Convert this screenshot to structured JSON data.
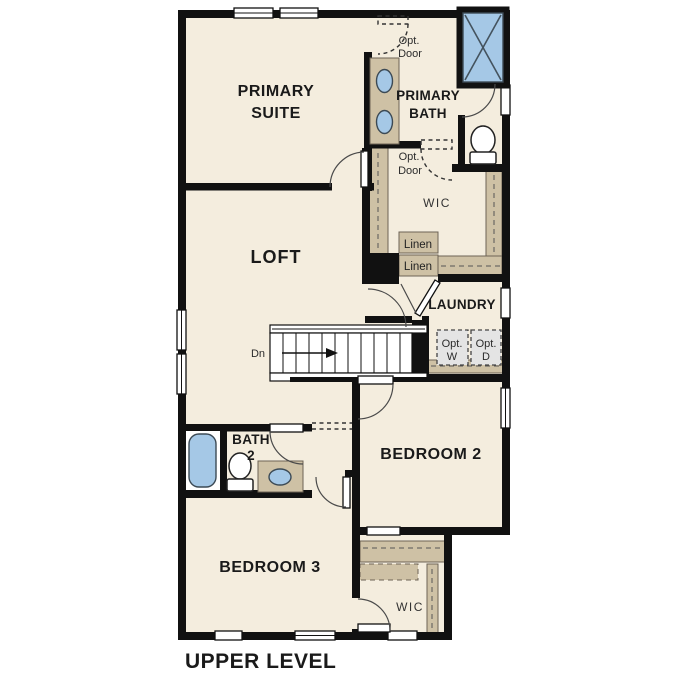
{
  "title": "UPPER LEVEL",
  "colors": {
    "floor": "#f4edde",
    "wall": "#111111",
    "cabinet": "#cec1a5",
    "fixture": "#a5c8e6",
    "appliance": "#e4e4e4"
  },
  "rooms": {
    "primary_suite": {
      "line1": "PRIMARY",
      "line2": "SUITE"
    },
    "primary_bath": {
      "line1": "PRIMARY",
      "line2": "BATH"
    },
    "loft": "LOFT",
    "wic_upper": "WIC",
    "laundry": "LAUNDRY",
    "bath2": {
      "line1": "BATH",
      "line2": "2"
    },
    "bedroom2": "BEDROOM 2",
    "bedroom3": "BEDROOM 3",
    "wic_lower": "WIC"
  },
  "annotations": {
    "opt_door_top": {
      "line1": "Opt.",
      "line2": "Door"
    },
    "opt_door_mid": {
      "line1": "Opt.",
      "line2": "Door"
    },
    "linen_upper": "Linen",
    "linen_lower": "Linen",
    "opt_washer": {
      "line1": "Opt.",
      "line2": "W"
    },
    "opt_dryer": {
      "line1": "Opt.",
      "line2": "D"
    },
    "stairs_down": "Dn"
  }
}
